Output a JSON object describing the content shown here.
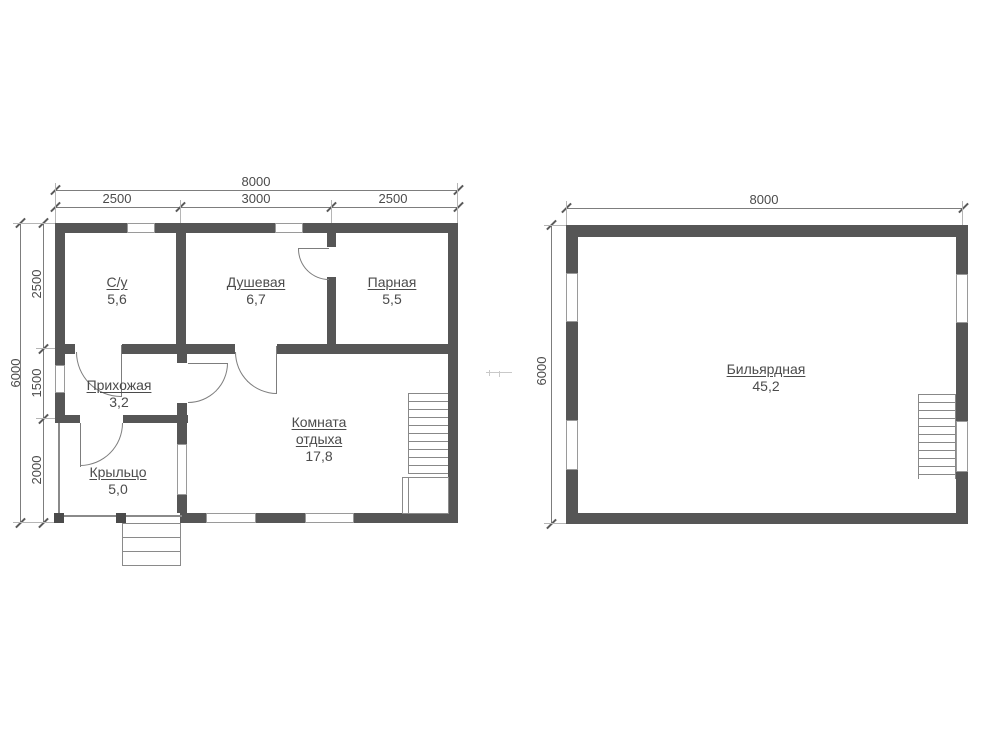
{
  "floor1": {
    "dim_width_total": "8000",
    "dim_width_segments": [
      "2500",
      "3000",
      "2500"
    ],
    "dim_height_total": "6000",
    "dim_height_segments": [
      "2500",
      "1500",
      "2000"
    ],
    "rooms": [
      {
        "name": "С/у",
        "area": "5,6"
      },
      {
        "name": "Душевая",
        "area": "6,7"
      },
      {
        "name": "Парная",
        "area": "5,5"
      },
      {
        "name": "Прихожая",
        "area": "3,2"
      },
      {
        "name": "Комната отдыха",
        "area": "17,8"
      },
      {
        "name": "Крыльцо",
        "area": "5,0"
      }
    ]
  },
  "floor2": {
    "dim_width_total": "8000",
    "dim_height_total": "6000",
    "rooms": [
      {
        "name": "Бильярдная",
        "area": "45,2"
      }
    ]
  },
  "colors": {
    "wall": "#565656",
    "thin_line": "#8a8a8a",
    "text": "#4b4b4b"
  }
}
